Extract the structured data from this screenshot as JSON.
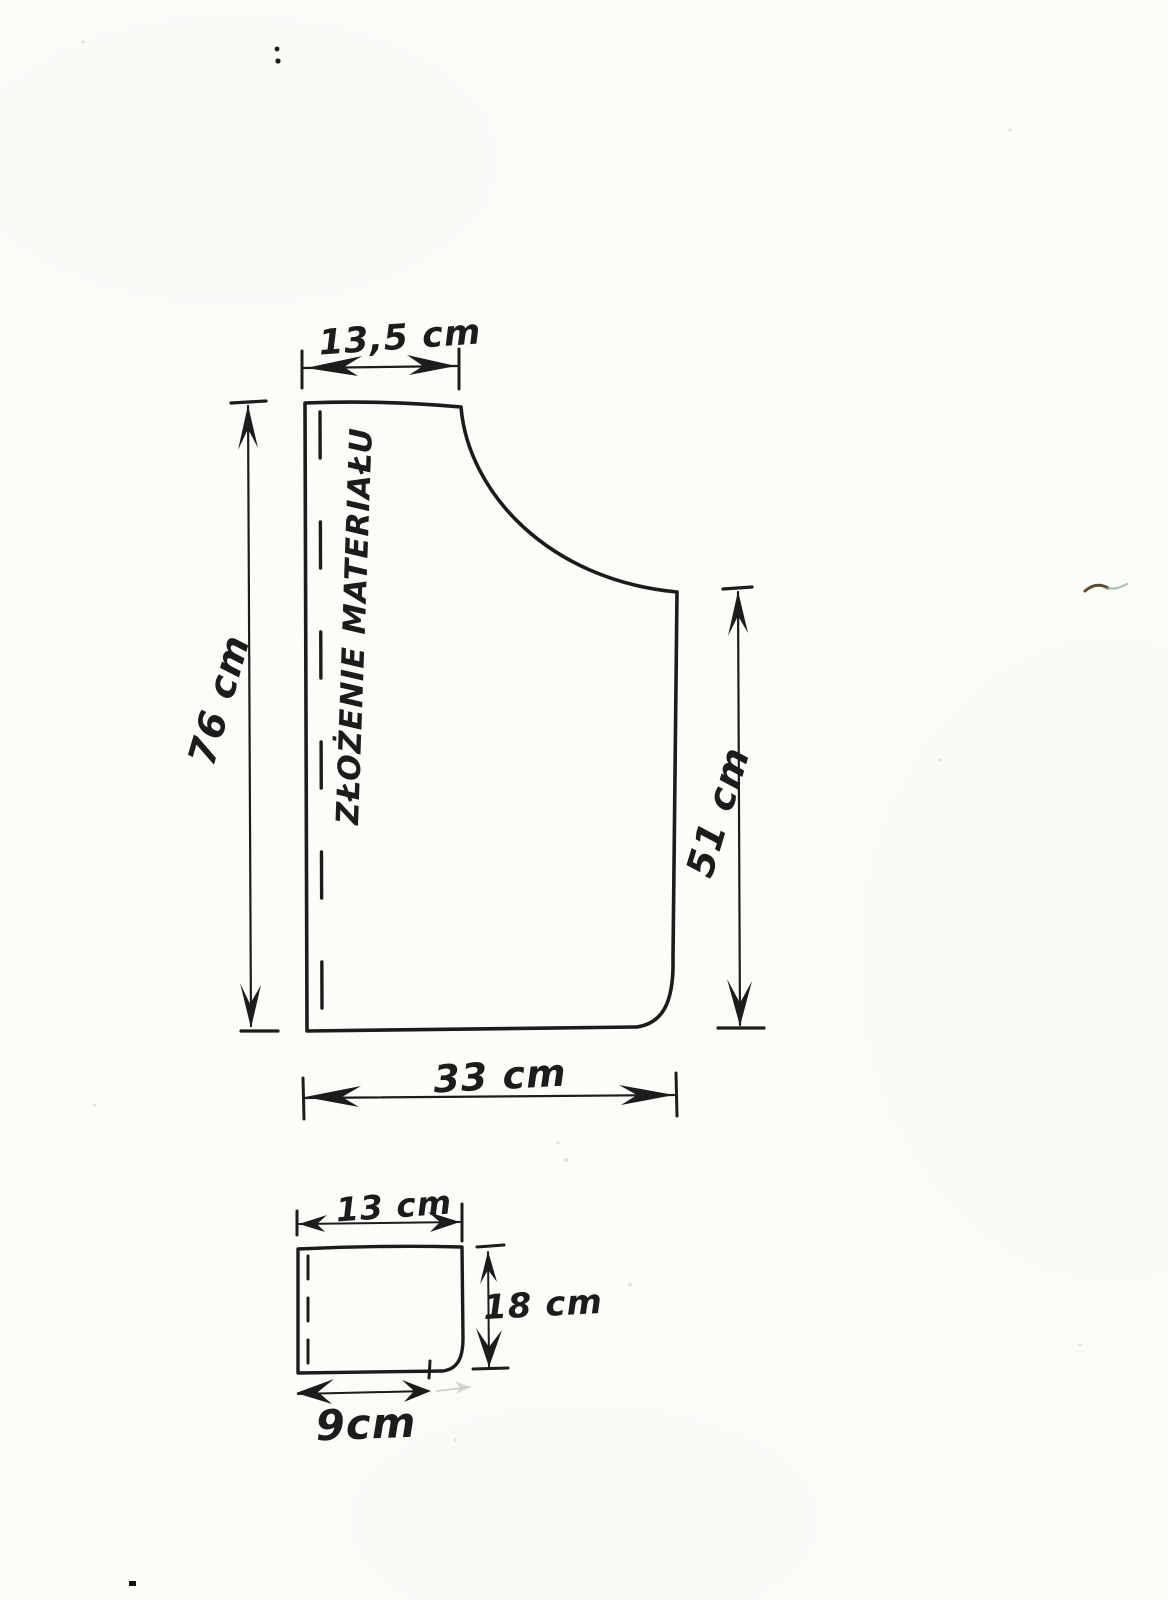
{
  "document_type": "hand-drawn sewing pattern sketch",
  "colors": {
    "paper": "#fcfcf9",
    "ink": "#1c1c1c",
    "smudge_brown": "#5f4a33",
    "smudge_teal": "#8fb3a4"
  },
  "pattern": {
    "fold_text": "ZŁOŻENIE MATERIAŁU",
    "main_piece": {
      "top_width": "13,5 cm",
      "left_height": "76 cm",
      "right_height": "51 cm",
      "bottom_width": "33 cm"
    },
    "pocket_piece": {
      "top_width": "13 cm",
      "right_height": "18 cm",
      "bottom_width": "9cm"
    }
  }
}
